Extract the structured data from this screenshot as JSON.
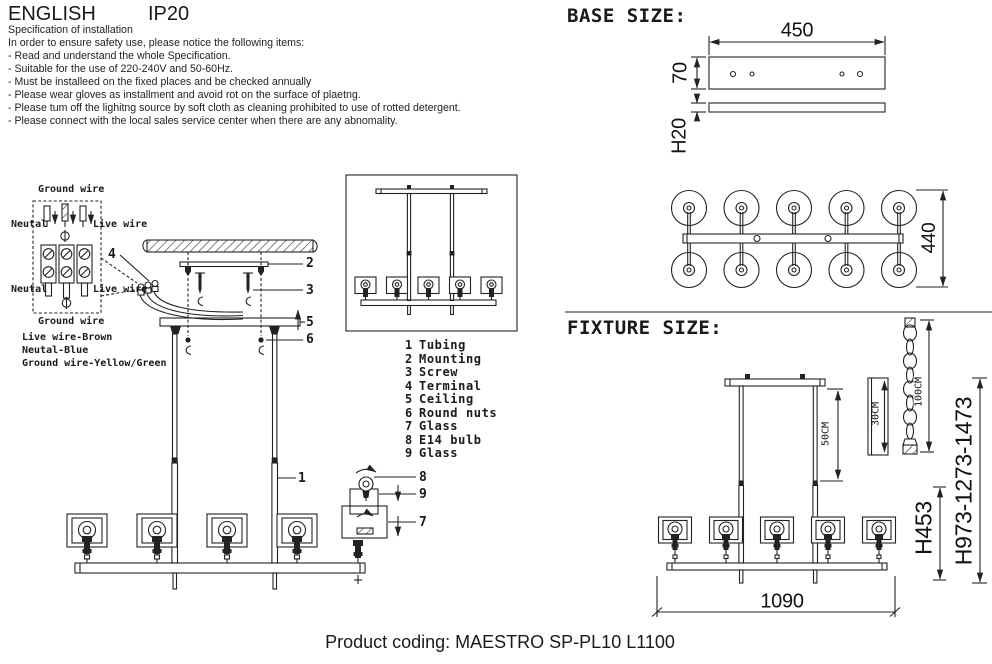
{
  "header": {
    "language": "ENGLISH",
    "ip_rating": "IP20"
  },
  "spec": {
    "title": "Specification of installation",
    "intro": "In order to ensure safety use, please notice the following items:",
    "items": [
      "- Read and understand the whole Specification.",
      "- Suitable for the use of 220-240V and 50-60Hz.",
      "- Must be installeed on the fixed places and be checked annually",
      "- Please wear gloves as installment and avoid rot on the surface of plaetng.",
      "- Please tum off the lighitng source by soft cloth as cleaning prohibited to use of rotted detergent.",
      "- Please connect with the local sales service center when there are any abnomality."
    ]
  },
  "wiring": {
    "ground_wire_top": "Ground wire",
    "neutral_left_top": "Neutal",
    "live_wire_right_top": "Live wire",
    "neutral_left_bottom": "Neutal",
    "live_wire_right_bottom": "Live wire",
    "ground_wire_bottom": "Ground wire",
    "legend": [
      "Live wire-Brown",
      "Neutal-Blue",
      "Ground wire-Yellow/Green"
    ]
  },
  "callouts": {
    "tubing": "1",
    "mounting": "2",
    "screw": "3",
    "terminal": "4",
    "ceiling": "5",
    "round_nuts": "6",
    "glass_shade": "7",
    "e14_bulb": "8",
    "glass_inner": "9"
  },
  "parts_list": [
    {
      "num": "1",
      "name": "Tubing"
    },
    {
      "num": "2",
      "name": "Mounting"
    },
    {
      "num": "3",
      "name": "Screw"
    },
    {
      "num": "4",
      "name": "Terminal"
    },
    {
      "num": "5",
      "name": "Ceiling"
    },
    {
      "num": "6",
      "name": "Round nuts"
    },
    {
      "num": "7",
      "name": "Glass"
    },
    {
      "num": "8",
      "name": "E14 bulb"
    },
    {
      "num": "9",
      "name": "Glass"
    }
  ],
  "base_size": {
    "title": "BASE SIZE:",
    "width": "450",
    "plate_height": "70",
    "plate_thickness": "H20",
    "depth": "440"
  },
  "fixture_size": {
    "title": "FIXTURE SIZE:",
    "rod_upper": "50CM",
    "rod_segment": "30CM",
    "chain": "100CM",
    "length": "1090",
    "fixture_height": "H453",
    "overall_height": "H973-1273-1473"
  },
  "footer": {
    "product_coding": "Product coding: MAESTRO SP-PL10 L1100"
  }
}
